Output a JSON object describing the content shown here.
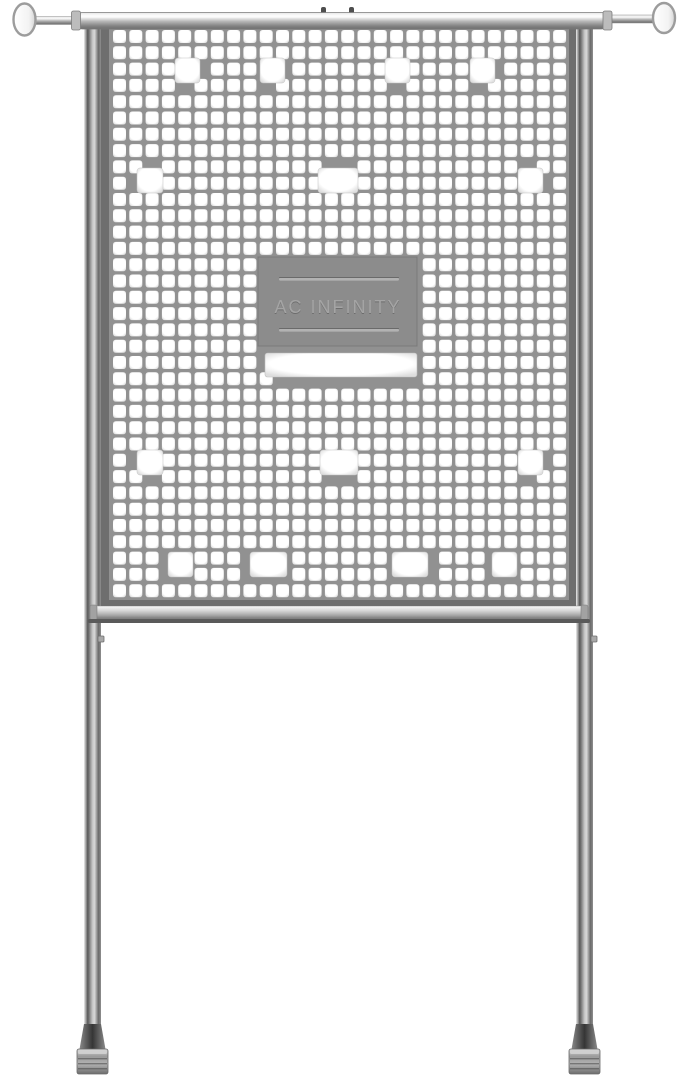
{
  "image": {
    "width": 679,
    "height": 1078,
    "background": "#ffffff"
  },
  "brand": {
    "text": "AC INFINITY"
  },
  "colors": {
    "mesh_web": "#919191",
    "frame": "#6e6e6e",
    "frame_rim": "#c9c9c9",
    "hole_white": "#ffffff",
    "hole_edge": "#dedede",
    "plate": "#8c8c8c",
    "plate_line": "#b2b2b2",
    "plate_line_shadow": "#6a6a6a",
    "brand_fill": "#a4a4a4",
    "brand_shadow": "#6d6d6d",
    "metal_light": "#f2f2f2",
    "metal_dark": "#6f6f6f",
    "rail_shadow": "#5a5a5a",
    "foot_dark": "#3f3f3f"
  },
  "mesh": {
    "x": 113,
    "y": 30,
    "cols": 28,
    "rows": 35,
    "pitch": 16.3,
    "hole_size": 13,
    "corner_radius": 2.6,
    "cover_threshold": 0.28
  },
  "large_holes": [
    {
      "x": 175,
      "y": 58,
      "w": 25,
      "h": 25
    },
    {
      "x": 260,
      "y": 58,
      "w": 25,
      "h": 25
    },
    {
      "x": 385,
      "y": 58,
      "w": 25,
      "h": 25
    },
    {
      "x": 470,
      "y": 58,
      "w": 25,
      "h": 25
    },
    {
      "x": 137,
      "y": 168,
      "w": 26,
      "h": 25
    },
    {
      "x": 318,
      "y": 168,
      "w": 40,
      "h": 25
    },
    {
      "x": 518,
      "y": 168,
      "w": 25,
      "h": 25
    },
    {
      "x": 137,
      "y": 450,
      "w": 26,
      "h": 25
    },
    {
      "x": 320,
      "y": 450,
      "w": 38,
      "h": 25
    },
    {
      "x": 518,
      "y": 450,
      "w": 25,
      "h": 25
    },
    {
      "x": 168,
      "y": 552,
      "w": 25,
      "h": 25
    },
    {
      "x": 250,
      "y": 552,
      "w": 37,
      "h": 25
    },
    {
      "x": 392,
      "y": 552,
      "w": 36,
      "h": 25
    },
    {
      "x": 492,
      "y": 552,
      "w": 25,
      "h": 25
    }
  ],
  "plate": {
    "x": 258,
    "y": 257,
    "w": 159,
    "h": 89,
    "lines": [
      {
        "x": 279,
        "y": 278,
        "w": 120,
        "h": 2.6
      },
      {
        "x": 279,
        "y": 329,
        "w": 120,
        "h": 2.6
      }
    ],
    "text_x": 338,
    "text_y": 313,
    "font_size": 18,
    "letter_spacing": 2
  },
  "slot": {
    "x": 265,
    "y": 353,
    "w": 152,
    "h": 24
  }
}
